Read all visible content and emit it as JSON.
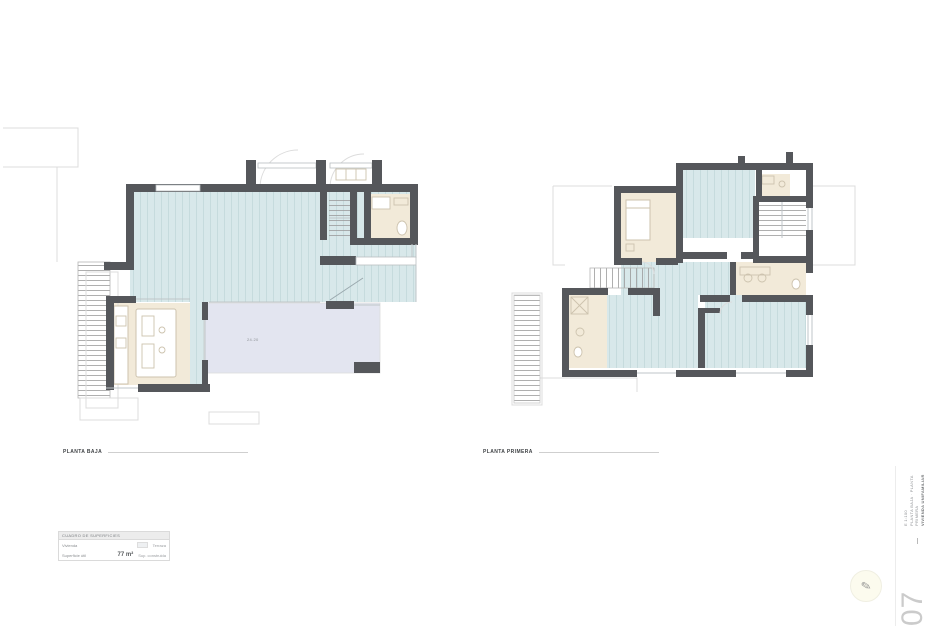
{
  "colors": {
    "wall": "#55575b",
    "floor_blue": "#d8e8ea",
    "plank": "#c2d8da",
    "floor_beige": "#f2ead9",
    "fixture": "#cdc3ae",
    "terrace": "#e3e5f0",
    "faint": "#dcdcdc",
    "tread": "#9b9b9b",
    "sheet_number": "#cbcbcb",
    "legend_border": "#dadada"
  },
  "plans": {
    "ground": {
      "label": "PLANTA BAJA",
      "terrace_label": "24.20"
    },
    "first": {
      "label": "PLANTA PRIMERA"
    }
  },
  "legend": {
    "header": "CUADRO DE SUPERFICIES",
    "rows": [
      {
        "left": "Vivienda",
        "mid": "",
        "right": "Terraza"
      },
      {
        "left": "Superficie útil",
        "mid": "77 m²",
        "right": "Sup. construida"
      }
    ]
  },
  "title_block": {
    "lines": [
      "VIVIENDA UNIFAMILIAR",
      "PLANTA BAJA · PLANTA PRIMERA",
      "E 1:100"
    ],
    "sheet_number": "07"
  },
  "logo_icon": "✎"
}
